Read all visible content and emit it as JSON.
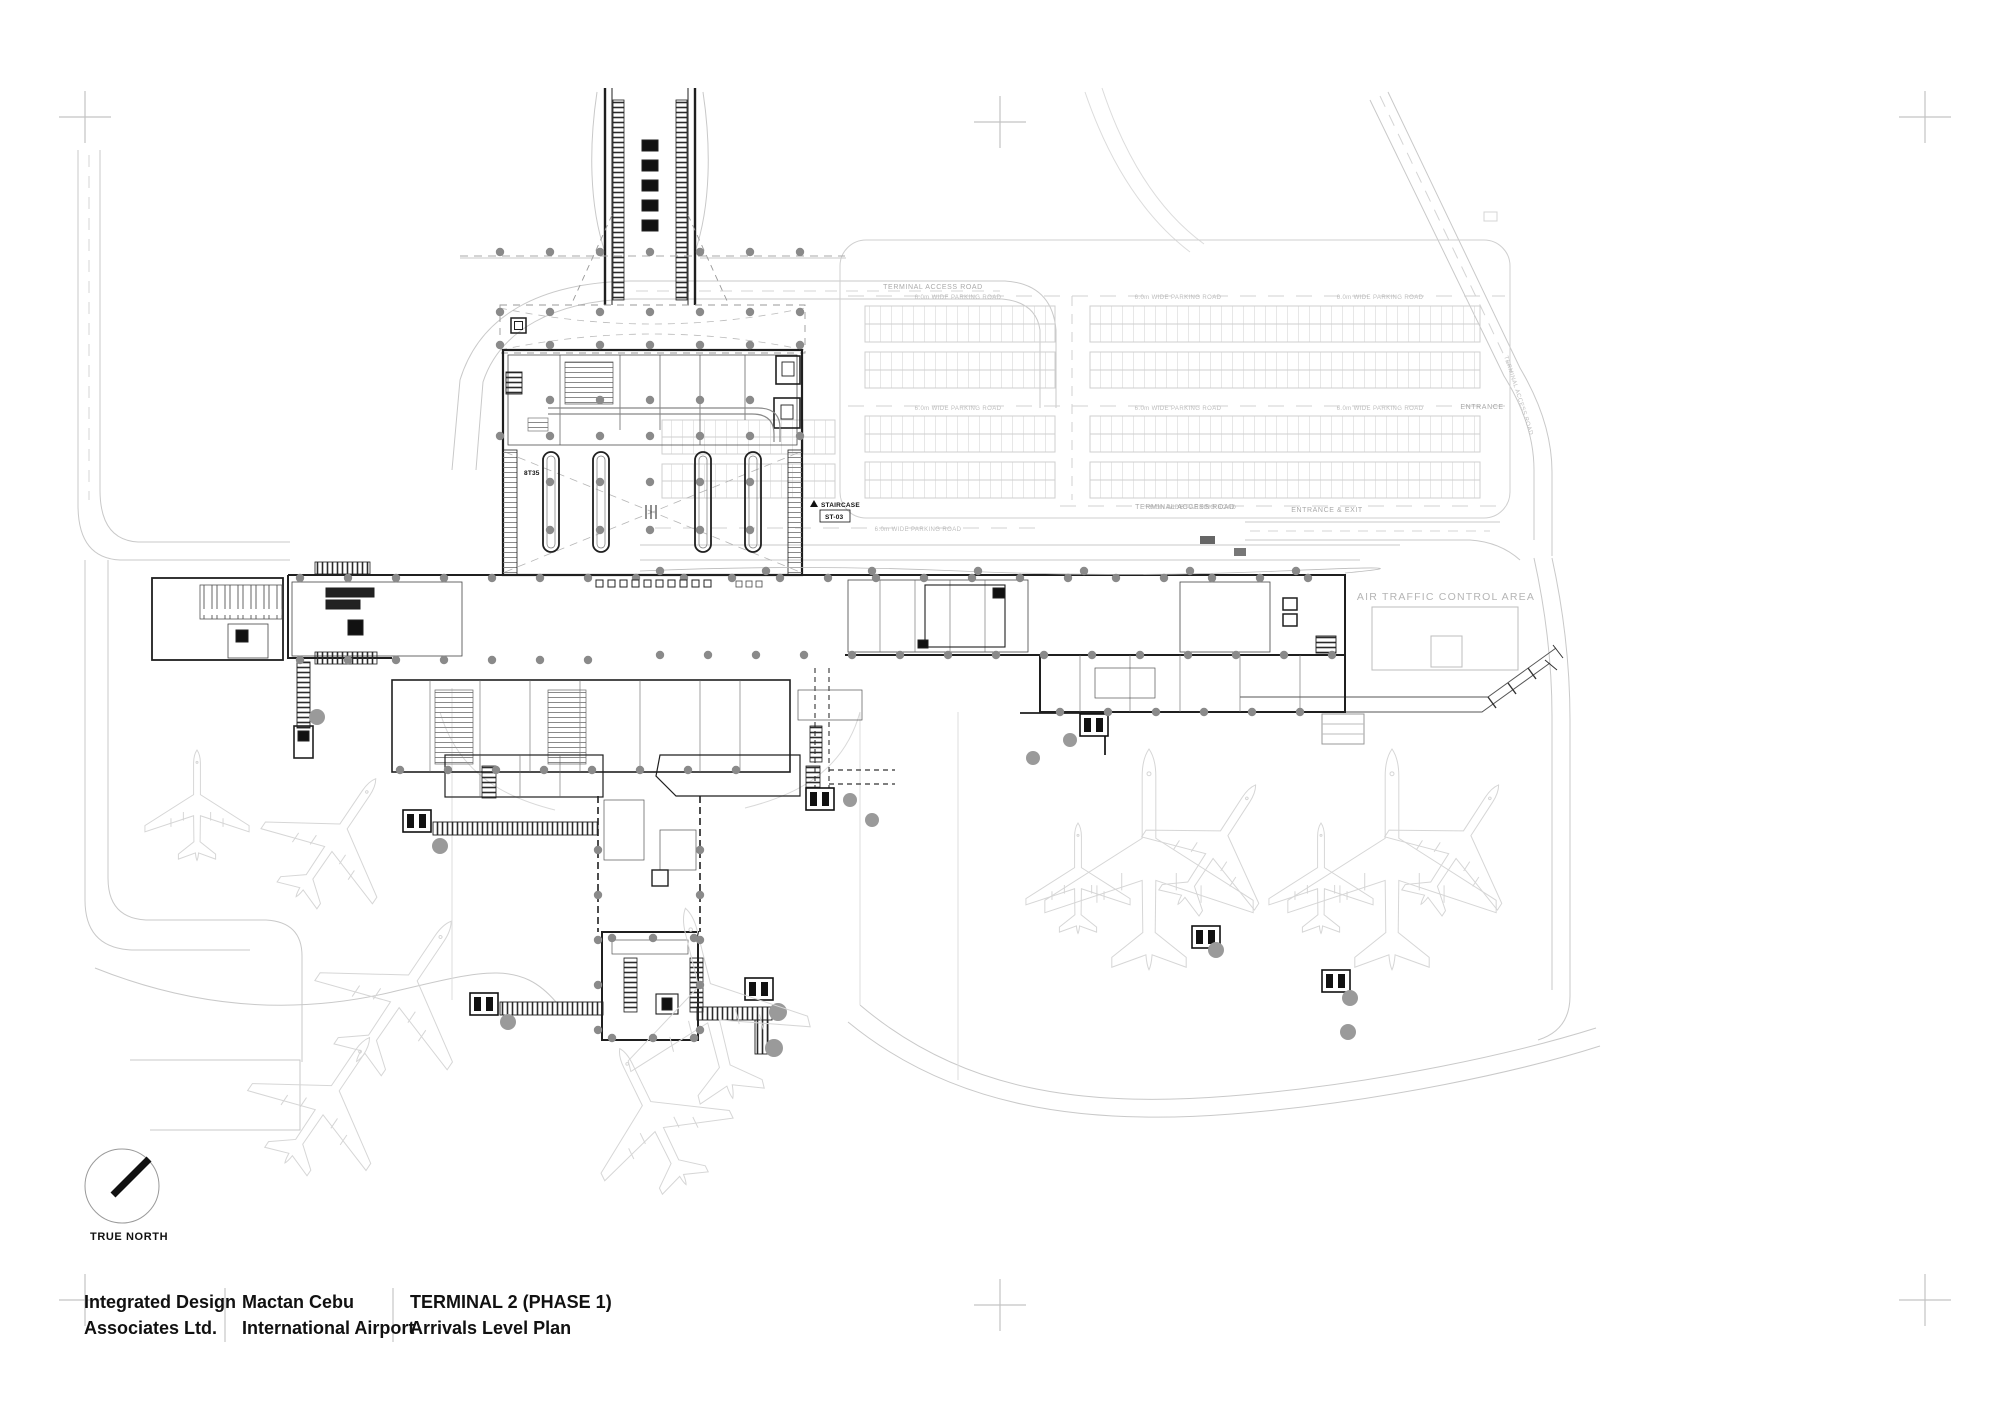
{
  "colors": {
    "paper": "#ffffff",
    "ink_dark": "#1f1f1f",
    "ink_mid": "#555555",
    "road_light": "#c9c9c9",
    "aircraft_ghost": "#d6d6d6",
    "label_gray": "#a9a9a9",
    "rotunda_gray": "#9a9a9a",
    "column_dot": "#8a8a8a"
  },
  "title_block": {
    "firm": [
      "Integrated Design",
      "Associates Ltd."
    ],
    "project": [
      "Mactan Cebu",
      "International Airport"
    ],
    "sheet": [
      "TERMINAL 2 (PHASE 1)",
      "Arrivals Level Plan"
    ]
  },
  "compass": {
    "label": "TRUE NORTH"
  },
  "plan_labels": {
    "terminal_access_road": "TERMINAL ACCESS ROAD",
    "parking_road": "6.0m WIDE PARKING ROAD",
    "entrance": "ENTRANCE",
    "entrance_exit": "ENTRANCE & EXIT",
    "atc": "AIR TRAFFIC CONTROL AREA",
    "staircase": "STAIRCASE",
    "staircase_id": "ST-03",
    "grid_note": "8T35"
  }
}
